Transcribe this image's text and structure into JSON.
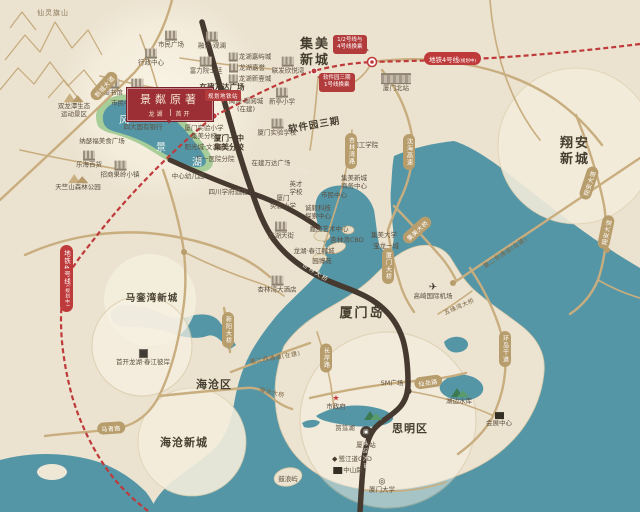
{
  "badge": {
    "title": "景粼原著",
    "dev_left": "龙湖",
    "dev_right": "首开"
  },
  "metro": {
    "line_label": "地铁4号线",
    "line_suffix": "(规划中)",
    "planned_station": "规划地铁站",
    "callout1_line1": "1/2号线与",
    "callout1_line2": "4号线换乘",
    "callout2_line1": "软件园三期",
    "callout2_line2": "1号线换乘"
  },
  "colors": {
    "water": "#5496a6",
    "land": "#ebe2cf",
    "road_dark": "#46392f",
    "road_tan": "#c8ad7f",
    "metro_red": "#bf3a3a",
    "badge_red": "#9c2f36",
    "lake_green": "#a7cd98"
  },
  "map": {
    "capsules": [
      {
        "id": "xincheng-avenue",
        "t": "新城大道",
        "x": 104,
        "y": 86,
        "r": -48
      },
      {
        "id": "shenhai-expressway",
        "t": "沈海高速",
        "x": 409,
        "y": 152,
        "v": 1
      },
      {
        "id": "xinglinwan-road",
        "t": "杏林湾路",
        "x": 351,
        "y": 151,
        "v": 1
      },
      {
        "id": "xiamen-bridge",
        "t": "厦门大桥",
        "x": 388,
        "y": 266,
        "v": 1
      },
      {
        "id": "jimei-bridge",
        "t": "集美大桥",
        "x": 417,
        "y": 230,
        "r": -42
      },
      {
        "id": "xiangan-avenue-north",
        "t": "翔安大道",
        "x": 589,
        "y": 183,
        "r": -72
      },
      {
        "id": "xiangan-avenue-south",
        "t": "翔安大道",
        "x": 606,
        "y": 232,
        "r": -78
      },
      {
        "id": "maqing-road",
        "t": "马青路",
        "x": 111,
        "y": 428,
        "r": -4
      },
      {
        "id": "xinyang-bridge",
        "t": "新阳大桥",
        "x": 228,
        "y": 330,
        "v": 1
      },
      {
        "id": "changan-road",
        "t": "长岸路",
        "x": 326,
        "y": 358,
        "v": 1
      },
      {
        "id": "xianyue-road",
        "t": "仙岳路",
        "x": 428,
        "y": 382,
        "r": -8
      },
      {
        "id": "huandao-avenue",
        "t": "环岛干道",
        "x": 505,
        "y": 349,
        "v": 1
      }
    ],
    "labels": [
      {
        "id": "xianling-qishan",
        "l": [
          "仙灵旗山"
        ],
        "x": 53,
        "y": 13,
        "cls": "poi-mtn"
      },
      {
        "id": "shuanglongtan-scenic",
        "l": [
          "双龙潭生态",
          "运动景区"
        ],
        "x": 74,
        "y": 106,
        "ic": "mtn"
      },
      {
        "id": "tianzhushan-forest-park",
        "l": [
          "天竺山森林公园"
        ],
        "x": 78,
        "y": 183,
        "ic": "mtn"
      },
      {
        "id": "lehai-department-store",
        "l": [
          "乐海百货"
        ],
        "x": 89,
        "y": 160,
        "ic": "bld"
      },
      {
        "id": "nasefu-food-plaza",
        "l": [
          "纳瑟福美食广场"
        ],
        "x": 102,
        "y": 142
      },
      {
        "id": "zhaoshang-guoling-town",
        "l": [
          "招商果岭小镇"
        ],
        "x": 120,
        "y": 170,
        "ic": "bld"
      },
      {
        "id": "citizen-square",
        "l": [
          "市民广场"
        ],
        "x": 171,
        "y": 40,
        "ic": "bld"
      },
      {
        "id": "administrative-center",
        "l": [
          "行政中心"
        ],
        "x": 151,
        "y": 58,
        "ic": "bld"
      },
      {
        "id": "library",
        "l": [
          "图书馆"
        ],
        "x": 113,
        "y": 88,
        "ic": "bld"
      },
      {
        "id": "natatorium",
        "l": [
          "游泳馆"
        ],
        "x": 137,
        "y": 88,
        "ic": "bld"
      },
      {
        "id": "citizen-center",
        "l": [
          "市民中心"
        ],
        "x": 124,
        "y": 104
      },
      {
        "id": "greentree-alliance-hotel",
        "l": [
          "格林联盟酒店"
        ],
        "x": 165,
        "y": 106,
        "ic": "bld"
      },
      {
        "id": "four-state-banks",
        "l": [
          "四大国有银行"
        ],
        "x": 143,
        "y": 128
      },
      {
        "id": "fengjing-square",
        "l": [
          "风景广场"
        ],
        "x": 186,
        "y": 120
      },
      {
        "id": "rf-yuanshiting",
        "l": [
          "富力院士廷"
        ],
        "x": 206,
        "y": 66,
        "ic": "bld"
      },
      {
        "id": "rongqiao-guanlan",
        "l": [
          "融侨·观澜"
        ],
        "x": 212,
        "y": 41,
        "ic": "bld"
      },
      {
        "id": "longhu-jiayucheng",
        "l": [
          "龙湖嘉屿城"
        ],
        "x": 250,
        "y": 57,
        "ic": "bld",
        "icpos": "left"
      },
      {
        "id": "longhu-jiayu",
        "l": [
          "龙湖嘉誉"
        ],
        "x": 247,
        "y": 68,
        "ic": "bld",
        "icpos": "left"
      },
      {
        "id": "longhu-xinyicheng",
        "l": [
          "龙湖新壹城"
        ],
        "x": 250,
        "y": 79,
        "ic": "bld",
        "icpos": "left"
      },
      {
        "id": "wanda-plaza-under-construction",
        "l": [
          "在建万达广场"
        ],
        "x": 222,
        "y": 87,
        "cls": "poi-bold"
      },
      {
        "id": "yuzhou-jingyuecheng",
        "l": [
          "禹洲·璟阅城",
          "(在建)"
        ],
        "x": 246,
        "y": 106
      },
      {
        "id": "xinting-primary-school",
        "l": [
          "新亭小学"
        ],
        "x": 282,
        "y": 97,
        "ic": "bld"
      },
      {
        "id": "xiamen-shiyan-school",
        "l": [
          "厦门实验学校"
        ],
        "x": 277,
        "y": 128,
        "ic": "bld"
      },
      {
        "id": "lianfa-xinyuewan",
        "l": [
          "联发欣悦湾"
        ],
        "x": 288,
        "y": 66,
        "ic": "bld"
      },
      {
        "id": "software-park-phase3",
        "l": [
          "软件园三期"
        ],
        "x": 314,
        "y": 124,
        "cls": "area-sm",
        "r": -10
      },
      {
        "id": "xiamen-institute-of-technology",
        "l": [
          "厦门工学院"
        ],
        "x": 362,
        "y": 146
      },
      {
        "id": "xiamen-yizhong-jimei",
        "l": [
          "厦门一中",
          "集美分校"
        ],
        "x": 229,
        "y": 143,
        "cls": "poi-bold"
      },
      {
        "id": "shiyan-primary-jimei-branch",
        "l": [
          "厦门实验小学",
          "集美分校"
        ],
        "x": 204,
        "y": 133
      },
      {
        "id": "yangguangcheng-wenlanfu",
        "l": [
          "阳光城·文澜府"
        ],
        "x": 205,
        "y": 148
      },
      {
        "id": "first-hospital-branch",
        "l": [
          "第一医院分院"
        ],
        "x": 215,
        "y": 160
      },
      {
        "id": "central-kindergarten",
        "l": [
          "中心幼儿园"
        ],
        "x": 188,
        "y": 177
      },
      {
        "id": "xuefu-hotel",
        "l": [
          "四川学府酒店"
        ],
        "x": 228,
        "y": 193
      },
      {
        "id": "wanda-plaza-small",
        "l": [
          "在建万达广场"
        ],
        "x": 271,
        "y": 164
      },
      {
        "id": "yingcai-school",
        "l": [
          "英才",
          "学校"
        ],
        "x": 296,
        "y": 189
      },
      {
        "id": "xiamen-shiyan-primary",
        "l": [
          "厦门",
          "实验小学"
        ],
        "x": 283,
        "y": 203
      },
      {
        "id": "chengyi-science-center",
        "l": [
          "诚毅科技",
          "探索中心"
        ],
        "x": 318,
        "y": 213
      },
      {
        "id": "jimei-business-center",
        "l": [
          "集美新城",
          "商务中心"
        ],
        "x": 354,
        "y": 183
      },
      {
        "id": "citizen-center-jimei",
        "l": [
          "市民中心"
        ],
        "x": 334,
        "y": 196
      },
      {
        "id": "longhu-paradise-walk",
        "l": [
          "龙湖天街"
        ],
        "x": 281,
        "y": 231,
        "ic": "bld"
      },
      {
        "id": "jiageng-art-center",
        "l": [
          "嘉庚艺术中心"
        ],
        "x": 329,
        "y": 230
      },
      {
        "id": "xinglinwan-cbd",
        "l": [
          "杏林湾CBD"
        ],
        "x": 347,
        "y": 241
      },
      {
        "id": "jimei-university",
        "l": [
          "集美大学"
        ],
        "x": 384,
        "y": 236
      },
      {
        "id": "powerlong-one-mall",
        "l": [
          "宝龙一城"
        ],
        "x": 386,
        "y": 247
      },
      {
        "id": "longhu-chunjiang-licheng",
        "l": [
          "龙湖·春江郦城"
        ],
        "x": 314,
        "y": 252
      },
      {
        "id": "yuanboyuan-garden-expo",
        "l": [
          "园博苑"
        ],
        "x": 322,
        "y": 262
      },
      {
        "id": "xinglinwan-hotel",
        "l": [
          "杏林湾大酒店"
        ],
        "x": 277,
        "y": 285,
        "ic": "bld"
      },
      {
        "id": "xiamen-north-station",
        "l": [
          "厦门北站"
        ],
        "x": 396,
        "y": 83,
        "ic": "station"
      },
      {
        "id": "gaoqi-international-airport",
        "l": [
          "高崎国际机场"
        ],
        "x": 433,
        "y": 292,
        "ic": "plane"
      },
      {
        "id": "xiamen-railway-station",
        "l": [
          "厦门站"
        ],
        "x": 366,
        "y": 438,
        "ic": "pin"
      },
      {
        "id": "sm-plaza",
        "l": [
          "SM广场"
        ],
        "x": 392,
        "y": 384
      },
      {
        "id": "city-government",
        "l": [
          "市政府"
        ],
        "x": 336,
        "y": 403,
        "ic": "star"
      },
      {
        "id": "yundang-lake",
        "l": [
          "筼筜湖"
        ],
        "x": 345,
        "y": 429
      },
      {
        "id": "egret-island",
        "l": [
          ""
        ],
        "x": 372,
        "y": 416,
        "ic": "palm"
      },
      {
        "id": "lujiangdao-cbd",
        "l": [
          "鹭江道CBD"
        ],
        "x": 352,
        "y": 460,
        "ic": "gem",
        "icpos": "left"
      },
      {
        "id": "zhongshan-road",
        "l": [
          "中山路"
        ],
        "x": 348,
        "y": 471,
        "ic": "blk",
        "icpos": "left"
      },
      {
        "id": "xiamen-university",
        "l": [
          "厦门大学"
        ],
        "x": 382,
        "y": 486,
        "ic": "school"
      },
      {
        "id": "gulangyu-island",
        "l": [
          "鼓浪屿"
        ],
        "x": 288,
        "y": 480
      },
      {
        "id": "convention-center",
        "l": [
          "会展中心"
        ],
        "x": 499,
        "y": 420,
        "ic": "blk"
      },
      {
        "id": "hubian-reservoir",
        "l": [
          "湖边水库"
        ],
        "x": 459,
        "y": 397,
        "ic": "palm"
      },
      {
        "id": "shoukai-longhu-chunjiang",
        "l": [
          "首开龙湖·春江彼岸"
        ],
        "x": 143,
        "y": 358,
        "ic": "logo"
      },
      {
        "id": "maluanwan-xincheng",
        "l": [
          "马銮湾新城"
        ],
        "x": 152,
        "y": 297,
        "cls": "area-sm"
      },
      {
        "id": "haicang-district",
        "l": [
          "海沧区"
        ],
        "x": 214,
        "y": 384,
        "cls": "area"
      },
      {
        "id": "haicang-xincheng",
        "l": [
          "海沧新城"
        ],
        "x": 184,
        "y": 442,
        "cls": "area"
      },
      {
        "id": "jimei-xincheng",
        "l": [
          "集美",
          "新城"
        ],
        "x": 315,
        "y": 53,
        "cls": "area-lg"
      },
      {
        "id": "xiangan-xincheng",
        "l": [
          "翔安",
          "新城"
        ],
        "x": 575,
        "y": 152,
        "cls": "area-lg"
      },
      {
        "id": "xiamen-island",
        "l": [
          "厦门岛"
        ],
        "x": 362,
        "y": 314,
        "cls": "area-lg"
      },
      {
        "id": "siming-district",
        "l": [
          "思明区"
        ],
        "x": 410,
        "y": 428,
        "cls": "area"
      },
      {
        "id": "fengjinghu-char-feng",
        "l": [
          "风"
        ],
        "x": 124,
        "y": 119,
        "cls": "lake-char"
      },
      {
        "id": "fengjinghu-char-jing",
        "l": [
          "景"
        ],
        "x": 161,
        "y": 146,
        "cls": "lake-char"
      },
      {
        "id": "fengjinghu-char-hu",
        "l": [
          "湖"
        ],
        "x": 197,
        "y": 161,
        "cls": "lake-char"
      },
      {
        "id": "haixiang-avenue",
        "l": [
          "海翔大道"
        ],
        "x": 296,
        "y": 168,
        "cls": "onroad",
        "r": 21
      },
      {
        "id": "xinglin-bridge",
        "l": [
          "杏林大桥"
        ],
        "x": 316,
        "y": 272,
        "cls": "onroad",
        "r": 33
      },
      {
        "id": "chenggong-avenue",
        "l": [
          "成功大道"
        ],
        "x": 366,
        "y": 455,
        "cls": "onroad",
        "r": 86
      },
      {
        "id": "haicang-bridge",
        "l": [
          "海沧大桥"
        ],
        "x": 272,
        "y": 392,
        "cls": "road-sm",
        "r": 14
      },
      {
        "id": "second-west-channel",
        "l": [
          "第二西通道(在建)"
        ],
        "x": 275,
        "y": 357,
        "cls": "road-sm",
        "r": -10
      },
      {
        "id": "second-east-channel",
        "l": [
          "第二东通道(在建)"
        ],
        "x": 505,
        "y": 252,
        "cls": "road-sm",
        "r": -34
      },
      {
        "id": "wuyuanwan-bridge",
        "l": [
          "五缘湾大桥"
        ],
        "x": 459,
        "y": 306,
        "cls": "road-sm",
        "r": -24
      }
    ]
  }
}
